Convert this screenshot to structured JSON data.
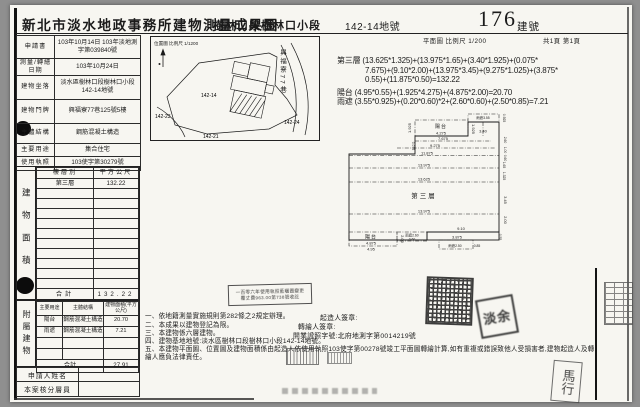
{
  "header": {
    "title": "新北市淡水地政事務所建物測量成果圖",
    "section_name": "樹林口段樹林口小段",
    "parcel_no": "142-14地號",
    "building_no": "176",
    "building_no_label": "建號",
    "plan_scale": "平面圖 比例尺 1/200",
    "page_info": "共1頁 第1頁"
  },
  "info_table": {
    "rows": [
      {
        "label": "申請書",
        "value": "103年10月14日 103年淡地測字第039840號"
      },
      {
        "label": "測量/轉繪日期",
        "value": "103年10月24日"
      },
      {
        "label": "建物坐落",
        "value": "淡水區樹林口段樹林口小段142-14地號"
      },
      {
        "label": "建物門牌",
        "value": "興福寮77巷125號5樓"
      },
      {
        "label": "主體結構",
        "value": "鋼筋混凝土構造"
      },
      {
        "label": "主要用途",
        "value": "集合住宅"
      },
      {
        "label": "使用執照",
        "value": "103使字第30279號"
      }
    ]
  },
  "floor_table": {
    "side_label": "建物面積",
    "headers": [
      "樓層別",
      "平方公尺"
    ],
    "rows": [
      [
        "第三層",
        "132.22"
      ],
      [
        "",
        ""
      ],
      [
        "",
        ""
      ],
      [
        "",
        ""
      ],
      [
        "",
        ""
      ],
      [
        "",
        ""
      ],
      [
        "",
        ""
      ],
      [
        "",
        ""
      ],
      [
        "",
        ""
      ],
      [
        "",
        ""
      ],
      [
        "",
        ""
      ]
    ],
    "total_label": "合計",
    "total": "132.22"
  },
  "annex_table": {
    "side_label": "附屬建物",
    "headers": [
      "主要用途",
      "主體結構",
      "建物面積(平方公尺)"
    ],
    "rows": [
      [
        "陽台",
        "鋼筋混凝土構造",
        "20.70"
      ],
      [
        "雨遮",
        "鋼筋混凝土構造",
        "7.21"
      ],
      [
        "",
        "",
        ""
      ],
      [
        "",
        "",
        ""
      ]
    ],
    "total_label": "合計",
    "total": "27.91"
  },
  "footer": {
    "applicant": "申請人姓名",
    "reviewer": "本案核分層員"
  },
  "location_map": {
    "scale_text": "位置圖 比例尺 1/1200",
    "parcels": [
      "142-14",
      "142-23",
      "142-21",
      "142-24"
    ],
    "street": "興福寮77巷"
  },
  "calculations": {
    "lines": [
      "第三層 (13.625*1.325)+(13.975*1.65)+(3.40*1.925)+(0.075*",
      "7.675)+(9.10*2.00)+(13.975*3.45)+(9.275*1.025)+(3.875*",
      "0.55)+(11.875*0.50)=132.22",
      "陽台 (4.95*0.55)+(1.925*4.275)+(4.875*2.00)=20.70",
      "雨遮 (3.55*0.925)+(0.20*0.60)*2+(2.60*0.60)+(2.50*0.85)=7.21"
    ]
  },
  "plan": {
    "floor_label": "第三層",
    "balcony_top": "陽台",
    "balcony_top_dim": "4.275",
    "canopy_top": "雨遮3.55",
    "canopy_top_dim": "0.925",
    "d7675": "7.675",
    "d9275": "9.275",
    "d11875": "11.875",
    "d13975a": "13.975",
    "d13625": "13.625",
    "d13975b": "13.975",
    "d340": "3.40",
    "d1925a": "1.925",
    "d1925b": "1.925",
    "d0075": "0.075",
    "d260": "2.60",
    "d100": "1.00",
    "d060": "0.60",
    "d165": "1.65",
    "d1325": "1.325",
    "d345": "3.45",
    "d200a": "2.00",
    "d200b": "2.00",
    "d055": "0.55",
    "balcony_bot": "陽台",
    "d4875": "4.875",
    "d495": "4.95",
    "canopy_mid": "雨遮2.60",
    "canopy_mid_dim": "0.60",
    "d910": "9.10",
    "d3875": "3.875",
    "canopy_bot": "雨遮2.50",
    "canopy_bot_dim": "0.85"
  },
  "notes": {
    "items": [
      "一、依地籍測量實施規則第282條之2規定辦理。",
      "二、本成果以建物登記為限。",
      "三、本建物係六層建物。",
      "四、建物基地地號:淡水區樹林口段樹林口小段142-14地號。",
      "五、本建物平面圖、位置圖及建物面積係由起造人依使用執照103使字第00278號竣工平面圖轉繪計算,如有重複或錯誤致他人受損害者,建物起造人及轉繪人應負法律責任。"
    ],
    "fee_stamp_lines": [
      "一百零六年使用執照藍曬圖變更",
      "覆丈費963.00第738號收訖"
    ],
    "signatures": {
      "builder": "起造人簽章:",
      "transcriber": "轉繪人簽章:",
      "license": "開業證照字號:北府地測字第0014219號"
    }
  },
  "stamps": {
    "transcriber_seal_text": "淡余",
    "handwritten_mark": "馬行"
  },
  "colors": {
    "paper": "#f7f6f1",
    "ink": "#1b1b1b",
    "background": "#8f8f8f"
  }
}
